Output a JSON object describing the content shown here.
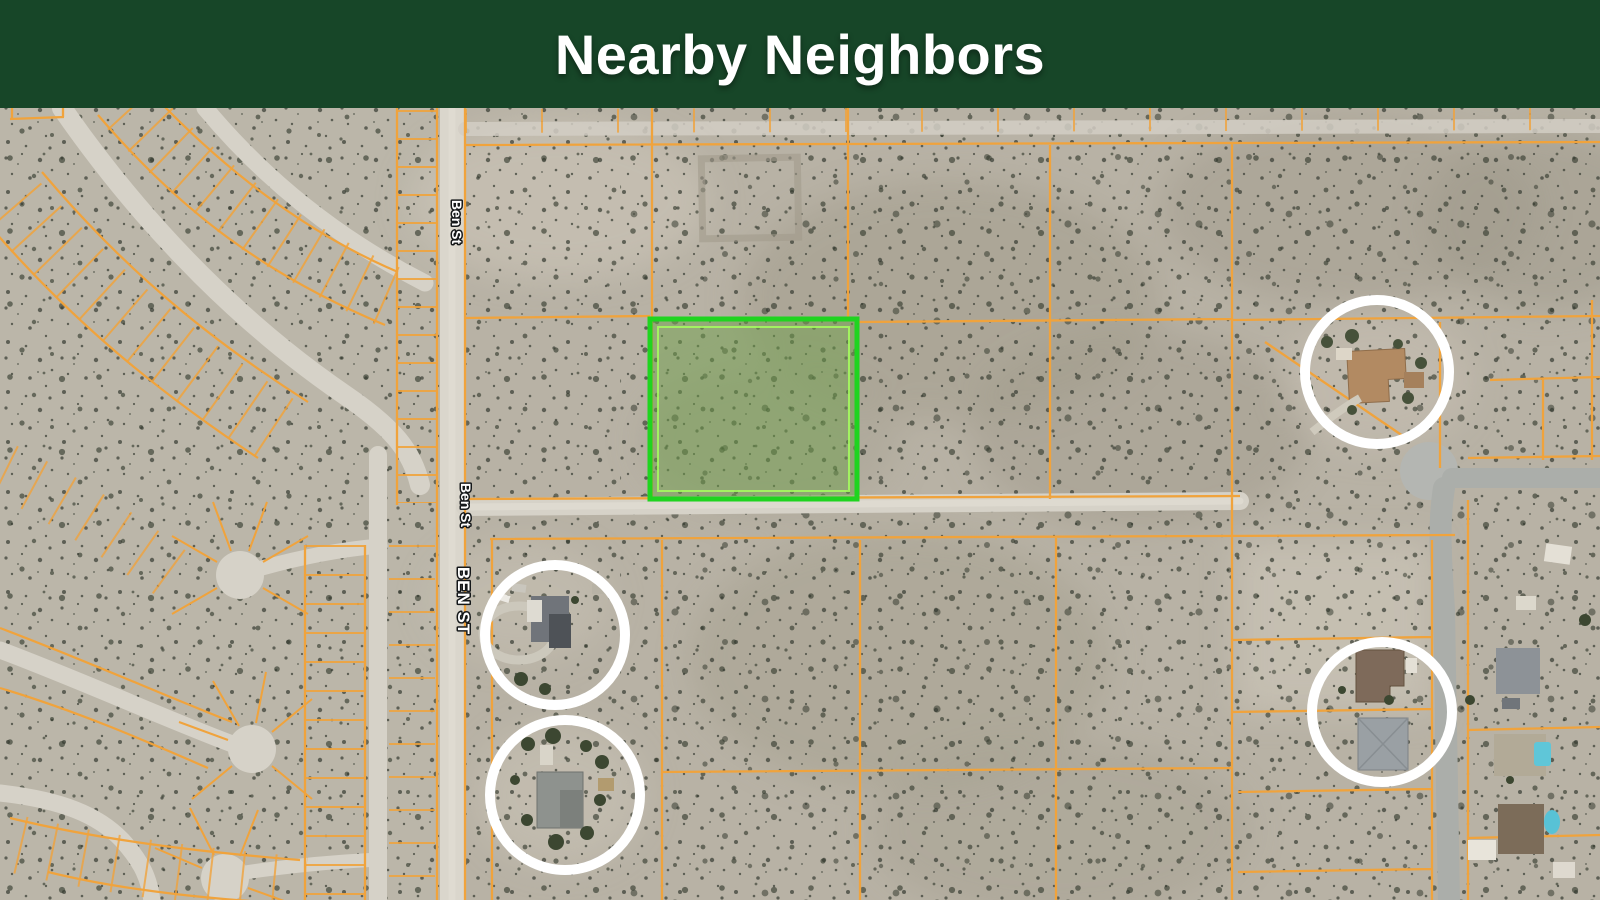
{
  "header": {
    "title": "Nearby Neighbors",
    "bg_color": "#174628",
    "text_color": "#ffffff"
  },
  "map": {
    "kind": "satellite-parcel-map",
    "street_labels": [
      {
        "text": "Ben St"
      },
      {
        "text": "Ben St"
      },
      {
        "text": "BEN ST"
      }
    ],
    "subject_parcel": {
      "x": 650,
      "y": 319,
      "width": 207,
      "height": 180
    },
    "markers": [
      {
        "cx": 1377,
        "cy": 372,
        "r": 72
      },
      {
        "cx": 555,
        "cy": 635,
        "r": 70
      },
      {
        "cx": 565,
        "cy": 795,
        "r": 75
      },
      {
        "cx": 1382,
        "cy": 712,
        "r": 70
      }
    ],
    "colors": {
      "parcel_line": "#f0a33c",
      "highlight_outline": "#1fd41f",
      "highlight_inner_outline": "#a6ff5e",
      "highlight_fill": "#6fa04b",
      "neighbor_ring": "#ffffff",
      "desert_base": "#b8b2a5",
      "dirt_road": "#d6d2c8",
      "paved_road": "#abaeaa"
    }
  }
}
